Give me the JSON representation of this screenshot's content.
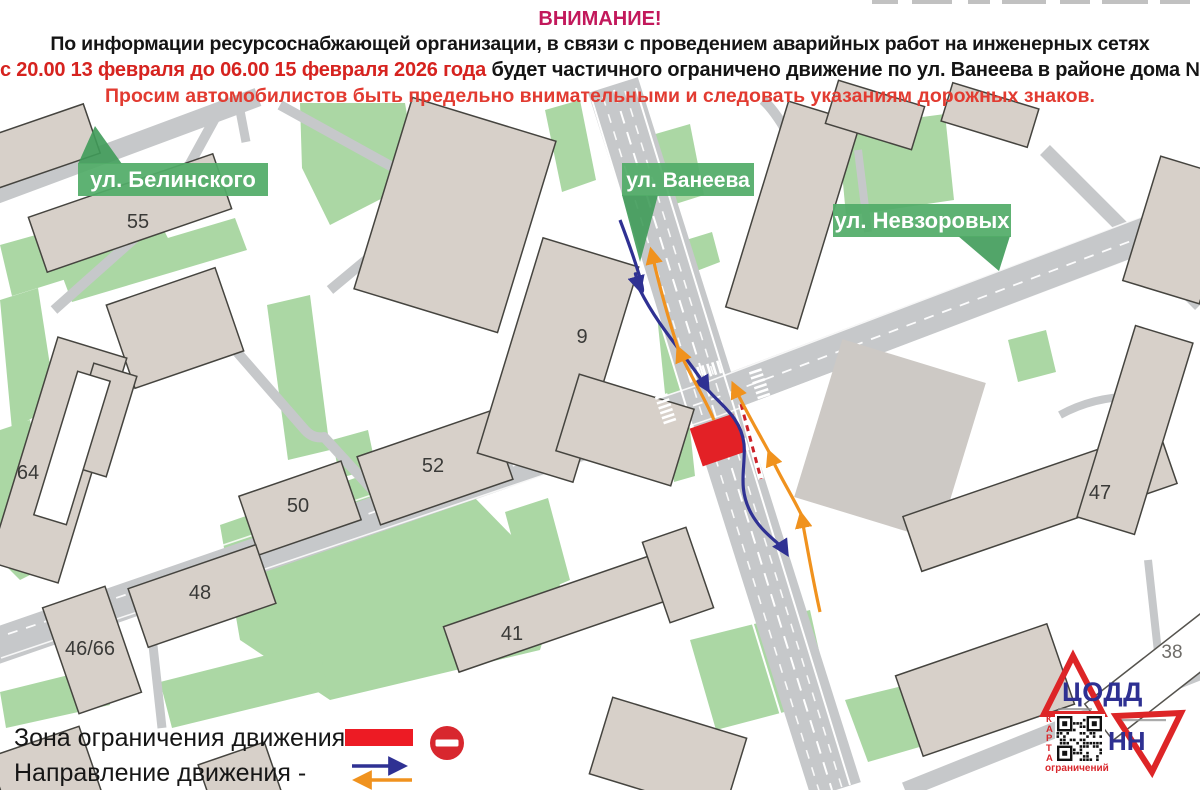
{
  "header": {
    "title": "ВНИМАНИЕ!",
    "line2": "По информации ресурсоснабжающей организации, в связи с проведением  аварийных работ на инженерных сетях",
    "line3_red": "с 20.00 13 февраля до 06.00 15 февраля 2026 года",
    "line3_rest": " будет частичного ограничено движение по ул. Ванеева в районе дома № 9.",
    "line4": "Просим автомобилистов быть предельно внимательными и следовать указаниям дорожных знаков."
  },
  "map": {
    "street_labels": {
      "belinskogo": "ул. Белинского",
      "vaneeva": "ул. Ванеева",
      "nevzorovykh": "ул. Невзоровых"
    },
    "buildings": {
      "b55": "55",
      "b9": "9",
      "b64": "64",
      "b52": "52",
      "b50": "50",
      "b48": "48",
      "b4666": "46/66",
      "b41": "41",
      "b47": "47",
      "b38": "38"
    }
  },
  "legend": {
    "zone_label": "Зона ограничения движения -",
    "direction_label": "Направление движения -"
  },
  "logo": {
    "codd": "ЦОДД",
    "nn": "НН",
    "karta": "КАРТА",
    "restrictions": "ограничений"
  },
  "colors": {
    "banner_green": "#52ac68",
    "banner_green_dark": "#3f9b59",
    "road_gray": "#c6c8ca",
    "building_fill": "#d7d0c9",
    "green_area": "#abd7a4",
    "restriction_red": "#e32126",
    "arrow_blue": "#2f3193",
    "arrow_orange": "#f0921e",
    "logo_red": "#dd2527",
    "logo_blue": "#2e3092"
  }
}
